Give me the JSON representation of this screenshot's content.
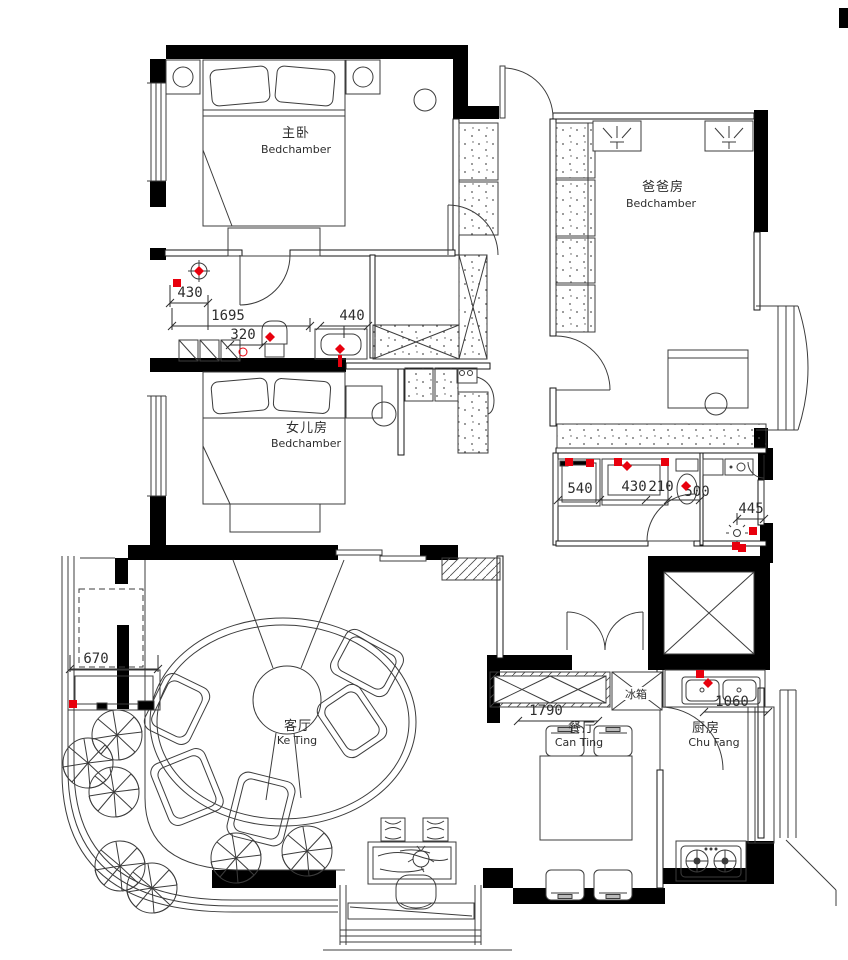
{
  "drawing": {
    "type": "residential-floor-plan",
    "rooms": {
      "master": {
        "zh": "主卧",
        "en": "Bedchamber"
      },
      "dad": {
        "zh": "爸爸房",
        "en": "Bedchamber"
      },
      "daughter": {
        "zh": "女儿房",
        "en": "Bedchamber"
      },
      "living": {
        "zh": "客厅",
        "en": "Ke Ting"
      },
      "dining": {
        "zh": "餐厅",
        "en": "Can Ting"
      },
      "kitchen": {
        "zh": "厨房",
        "en": "Chu Fang"
      }
    },
    "appliances": {
      "fridge": "冰箱"
    },
    "dims": {
      "bath1_width": "430",
      "hall_run": "1695",
      "shoe_cab": "320",
      "vanity1": "440",
      "washer": "540",
      "vanity2": "430",
      "gap": "210",
      "toilet": "500",
      "shower": "445",
      "balcony_cab": "670",
      "sideboard": "1790",
      "kitchen_counter": "1060"
    },
    "symbols": {
      "plant": "pinwheel-shrub",
      "elevator": "crossed-box-shaft",
      "door": "quarter-arc-swing",
      "window": "parallel-line-band",
      "wardrobe": "stippled-cabinet",
      "plumbing": "red-marker"
    },
    "colors": {
      "wall": "#000000",
      "line": "#3c3c3c",
      "red": "#e8000d",
      "bg": "#ffffff"
    }
  }
}
